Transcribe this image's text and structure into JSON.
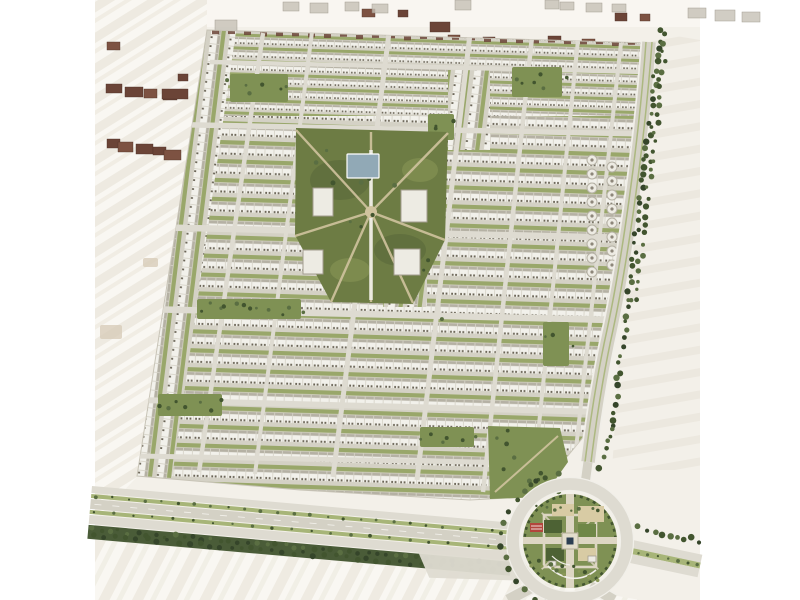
{
  "meta": {
    "type": "aerial-masterplan-rendering",
    "subject": "residential-community-site-plan"
  },
  "palette": {
    "page_bg": "#ffffff",
    "sand_base": "#f3f0e9",
    "sand_light": "#f9f7f2",
    "sand_streak": "#e5dfd2",
    "sand_streak_light": "#efebe1",
    "sand_patch": "#d6c9b6",
    "street": "#d4d1c5",
    "street_light": "#dedbd1",
    "road_white": "#f1efe9",
    "house": "#f2f1eb",
    "roof": "#b5b1a4",
    "speck": "#6a6456",
    "lawn": "#99a76a",
    "lawn_dark": "#7f9154",
    "park_olive": "#6d7c44",
    "park_dark": "#57663a",
    "park_light": "#8a9858",
    "tree_dark": "#42552f",
    "tree_mid": "#5a6e42",
    "tree_deep": "#35452a",
    "path_tan": "#d0c39e",
    "plaza_tan": "#d8cba4",
    "blue_roof": "#91a9b6",
    "building_white": "#edebe3",
    "building_stroke": "#a29d8f",
    "brown_dark": "#6b4437",
    "brown_mid": "#7d5242",
    "gray_block": "#c6c1b6",
    "gray_block_dark": "#8d867a",
    "red_bed": "#b2463c",
    "navy": "#2d3e52",
    "median_green": "#a7b578",
    "tree_band": "#4a5c38",
    "bed_green": "#4d6234",
    "bed_light": "#6f8747",
    "outline": "#c8c4b7"
  },
  "scene": {
    "canvas": {
      "w": 800,
      "h": 600,
      "content_left": 95,
      "content_right": 700
    },
    "community_clip": [
      [
        207,
        30
      ],
      [
        649,
        43
      ],
      [
        631,
        170
      ],
      [
        611,
        300
      ],
      [
        589,
        430
      ],
      [
        566,
        458
      ],
      [
        544,
        496
      ],
      [
        470,
        500
      ],
      [
        300,
        490
      ],
      [
        137,
        476
      ]
    ],
    "zones": {
      "top": [
        150,
        28,
        510,
        92
      ],
      "main": [
        128,
        116,
        532,
        386
      ],
      "left_strip": [
        [
          207,
          30
        ],
        [
          236,
          31
        ],
        [
          172,
          478
        ],
        [
          137,
          476
        ]
      ],
      "vertical_patches": [
        [
          448,
          70,
          42,
          80
        ],
        [
          383,
          253,
          44,
          54
        ]
      ]
    },
    "streets_h": [
      [
        210,
        62,
        648,
        72,
        4.5
      ],
      [
        146,
        124,
        646,
        134,
        5.5
      ],
      [
        143,
        227,
        634,
        238,
        6.5
      ],
      [
        141,
        309,
        618,
        320,
        6.5
      ],
      [
        139,
        400,
        600,
        412,
        6
      ],
      [
        138,
        456,
        582,
        464,
        5
      ]
    ],
    "streets_v": [
      [
        263,
        33,
        199,
        472,
        4.5
      ],
      [
        312,
        32,
        255,
        474,
        4
      ],
      [
        389,
        33,
        333,
        477,
        5
      ],
      [
        470,
        34,
        417,
        480,
        5
      ],
      [
        532,
        37,
        483,
        492,
        4.5
      ],
      [
        578,
        40,
        532,
        494,
        4
      ],
      [
        621,
        43,
        575,
        458,
        4
      ]
    ],
    "pocket_parks": [
      [
        230,
        74,
        58,
        28
      ],
      [
        512,
        67,
        50,
        30
      ],
      [
        197,
        299,
        104,
        20
      ],
      [
        158,
        394,
        64,
        22
      ],
      [
        420,
        427,
        54,
        20
      ],
      [
        543,
        322,
        26,
        44
      ],
      [
        428,
        114,
        26,
        26
      ]
    ],
    "se_wedge": [
      [
        488,
        426
      ],
      [
        560,
        428
      ],
      [
        568,
        462
      ],
      [
        543,
        497
      ],
      [
        490,
        499
      ]
    ],
    "central_park": {
      "outline": [
        [
          296,
          128
        ],
        [
          448,
          132
        ],
        [
          445,
          240
        ],
        [
          413,
          304
        ],
        [
          331,
          302
        ],
        [
          295,
          235
        ]
      ],
      "center": [
        371,
        212
      ],
      "rays": [
        [
          296,
          130
        ],
        [
          448,
          133
        ],
        [
          445,
          240
        ],
        [
          413,
          303
        ],
        [
          331,
          302
        ],
        [
          295,
          236
        ],
        [
          371,
          132
        ],
        [
          371,
          302
        ]
      ],
      "blue_building": [
        347,
        154,
        32,
        24
      ],
      "white_buildings": [
        [
          313,
          188,
          20,
          28
        ],
        [
          401,
          190,
          26,
          32
        ],
        [
          303,
          250,
          20,
          24
        ],
        [
          394,
          249,
          26,
          26
        ]
      ],
      "promenade": [
        371,
        150,
        371,
        300
      ],
      "blotches": [
        [
          340,
          180,
          30,
          20
        ],
        [
          400,
          250,
          26,
          16
        ],
        [
          350,
          270,
          20,
          12
        ],
        [
          420,
          170,
          18,
          12
        ]
      ]
    },
    "round_buildings": {
      "r": 5,
      "cols": [
        {
          "x": 592,
          "ys": [
            160,
            174,
            188,
            202,
            216,
            230,
            244,
            258,
            272
          ]
        },
        {
          "x": 612,
          "ys": [
            167,
            181,
            195,
            209,
            223,
            237,
            251,
            265
          ]
        }
      ]
    },
    "corridor": {
      "path": "M649,42 C642,140 625,260 610,330 C600,375 592,430 588,462"
    },
    "tree_lines": [
      {
        "from": [
          660,
          32
        ],
        "to": [
          646,
          158
        ],
        "n": 18,
        "rows": 2
      },
      {
        "from": [
          646,
          158
        ],
        "to": [
          629,
          298
        ],
        "n": 19,
        "rows": 2
      },
      {
        "from": [
          629,
          298
        ],
        "to": [
          612,
          428
        ],
        "n": 17,
        "rows": 1
      },
      {
        "from": [
          612,
          428
        ],
        "to": [
          601,
          466
        ],
        "n": 6,
        "rows": 1
      },
      {
        "from": [
          638,
          528
        ],
        "to": [
          700,
          541
        ],
        "n": 9,
        "rows": 1
      }
    ],
    "ring_tree_arc": {
      "cx": 570,
      "cy": 541,
      "r": 68,
      "a1": 80,
      "a2": 260,
      "n": 18
    },
    "boulevard": {
      "origin": [
        92,
        486
      ],
      "angle": 5,
      "length": 424,
      "bands": [
        {
          "y": 0,
          "h": 7,
          "color": "street_light"
        },
        {
          "y": 8,
          "h": 4,
          "color": "median_green",
          "dots": 26
        },
        {
          "y": 13,
          "h": 10,
          "color": "street",
          "dashes": true
        },
        {
          "y": 24,
          "h": 4,
          "color": "median_green",
          "dots": 22
        },
        {
          "y": 29,
          "h": 9,
          "color": "street_light"
        },
        {
          "y": 39,
          "h": 14,
          "color": "tree_band",
          "treedots": 46
        }
      ],
      "junction": [
        [
          330,
          36
        ],
        [
          428,
          26
        ],
        [
          452,
          56
        ],
        [
          344,
          62
        ]
      ]
    },
    "east_road": {
      "origin": [
        628,
        539
      ],
      "angle": 12,
      "length": 76,
      "bands": [
        {
          "y": 0,
          "h": 8,
          "color": "street_light"
        },
        {
          "y": 8,
          "h": 6,
          "color": "median_green",
          "dots": 8
        },
        {
          "y": 14,
          "h": 9,
          "color": "street_light"
        }
      ]
    },
    "spur_roads": [
      [
        538,
        584,
        508,
        600,
        11
      ],
      [
        590,
        586,
        614,
        600,
        10
      ],
      [
        588,
        462,
        585,
        484,
        9
      ]
    ],
    "roundabout": {
      "cx": 570,
      "cy": 541,
      "ring_r": 57,
      "ring_w": 13,
      "park_r": 47,
      "cross_h": [
        523,
        537,
        94,
        7
      ],
      "cross_v": [
        566,
        494,
        8,
        94
      ],
      "inner_square": [
        544,
        515,
        52,
        52
      ],
      "beds": [
        {
          "r": [
            578,
            506,
            26,
            16
          ],
          "color": "plaza_tan"
        },
        {
          "r": [
            552,
            504,
            22,
            12
          ],
          "color": "plaza_tan"
        },
        {
          "r": [
            544,
            520,
            18,
            13
          ],
          "color": "bed_green"
        },
        {
          "r": [
            578,
            524,
            18,
            13
          ],
          "color": "bed_light"
        },
        {
          "r": [
            546,
            548,
            18,
            13
          ],
          "color": "bed_green"
        },
        {
          "r": [
            578,
            548,
            18,
            13
          ],
          "color": "plaza_tan"
        }
      ],
      "red_bed": [
        530,
        523,
        13,
        9
      ],
      "center_plaza": [
        562,
        533,
        16,
        16
      ],
      "center_core": [
        566.5,
        537.5,
        7,
        7
      ],
      "kiosks": [
        [
          588,
          556,
          8,
          6
        ],
        [
          549,
          561,
          7,
          5
        ]
      ],
      "s_tree_dots": 14
    },
    "outside_buildings": {
      "brown": [
        [
          107,
          42,
          13,
          8
        ],
        [
          106,
          84,
          16,
          9
        ],
        [
          125,
          87,
          18,
          10
        ],
        [
          144,
          89,
          13,
          9
        ],
        [
          163,
          92,
          14,
          8
        ],
        [
          107,
          139,
          13,
          9
        ],
        [
          118,
          142,
          15,
          10
        ],
        [
          136,
          144,
          17,
          10
        ],
        [
          153,
          147,
          13,
          8
        ],
        [
          164,
          150,
          17,
          10
        ],
        [
          178,
          74,
          10,
          7
        ],
        [
          162,
          89,
          26,
          10
        ],
        [
          230,
          31,
          10,
          7
        ],
        [
          278,
          34,
          17,
          8
        ],
        [
          300,
          35,
          14,
          8
        ],
        [
          362,
          9,
          13,
          8
        ],
        [
          398,
          10,
          10,
          7
        ],
        [
          430,
          22,
          20,
          10
        ],
        [
          448,
          35,
          12,
          8
        ],
        [
          483,
          37,
          12,
          7
        ],
        [
          548,
          36,
          13,
          8
        ],
        [
          582,
          39,
          13,
          7
        ],
        [
          598,
          42,
          20,
          8
        ],
        [
          615,
          13,
          12,
          8
        ],
        [
          640,
          14,
          10,
          7
        ],
        [
          225,
          236,
          44,
          20
        ]
      ],
      "gray": [
        [
          215,
          20,
          22,
          11
        ],
        [
          283,
          2,
          16,
          9
        ],
        [
          310,
          3,
          18,
          10
        ],
        [
          345,
          2,
          14,
          9
        ],
        [
          372,
          4,
          16,
          9
        ],
        [
          455,
          0,
          16,
          10
        ],
        [
          545,
          0,
          14,
          9
        ],
        [
          560,
          2,
          14,
          8
        ],
        [
          586,
          3,
          16,
          9
        ],
        [
          612,
          4,
          14,
          8
        ],
        [
          688,
          8,
          18,
          10
        ],
        [
          715,
          10,
          20,
          11
        ],
        [
          742,
          12,
          18,
          10
        ]
      ]
    },
    "top_speck_row": {
      "x0": 212,
      "x1": 652,
      "step": 16,
      "y0": 30,
      "slope": 0.028,
      "w": 7,
      "h": 4
    },
    "desert": {
      "west_clip": [
        [
          95,
          0
        ],
        [
          207,
          0
        ],
        [
          207,
          30
        ],
        [
          137,
          477
        ],
        [
          95,
          520
        ]
      ],
      "east_clip": [
        [
          640,
          30
        ],
        [
          700,
          40
        ],
        [
          700,
          470
        ],
        [
          612,
          470
        ]
      ],
      "south_clip": [
        [
          95,
          540
        ],
        [
          300,
          558
        ],
        [
          510,
          577
        ],
        [
          640,
          600
        ],
        [
          95,
          600
        ]
      ],
      "north_strip": [
        95,
        0,
        605,
        27
      ],
      "patches": [
        [
          100,
          325,
          22,
          14
        ],
        [
          143,
          258,
          15,
          9
        ]
      ]
    }
  }
}
